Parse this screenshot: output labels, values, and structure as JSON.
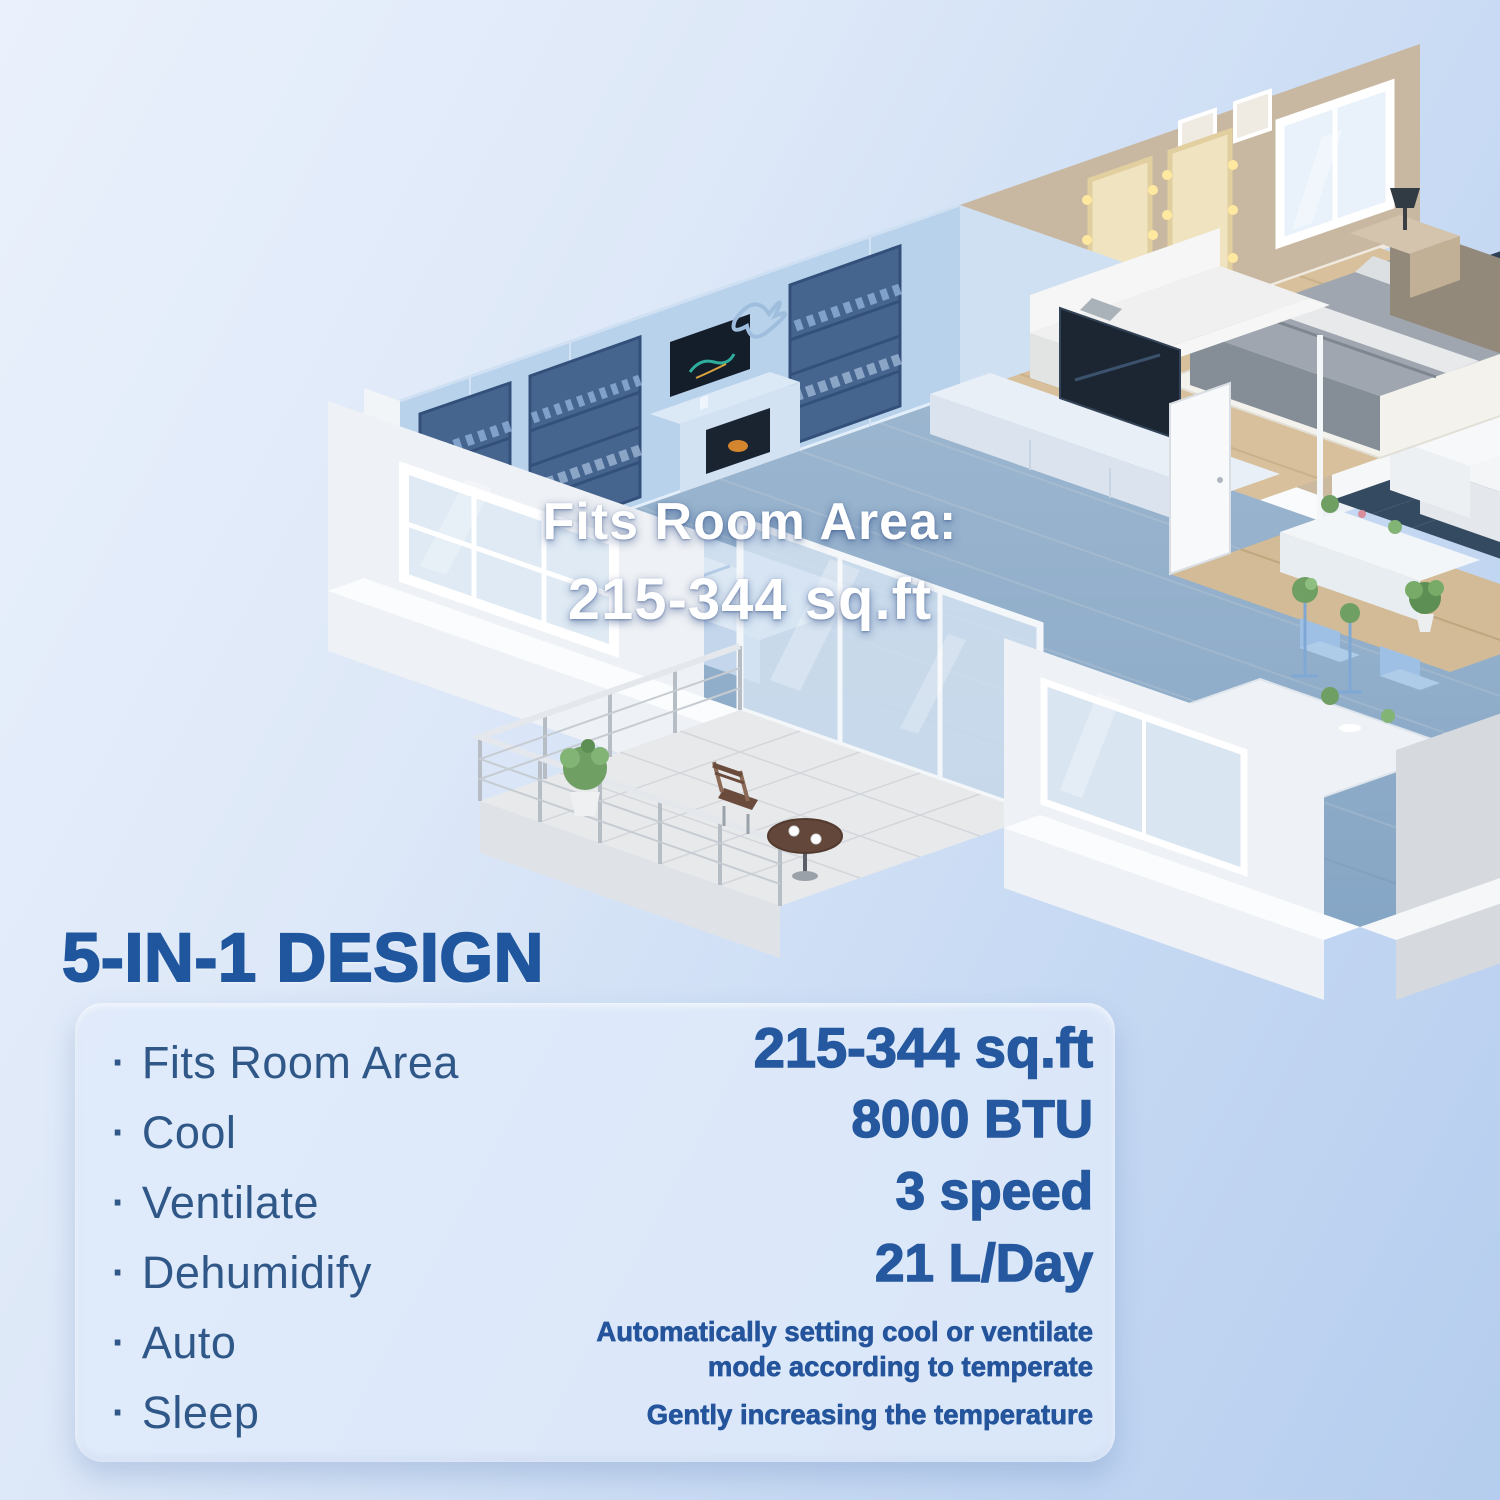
{
  "scene": {
    "name": "3d-apartment-cutaway-floorplan",
    "floor_label": {
      "line1": "Fits Room Area:",
      "line2": "215-344 sq.ft"
    }
  },
  "heading": "5-IN-1 DESIGN",
  "features": {
    "bullet": "·",
    "items": [
      "Fits Room Area",
      "Cool",
      "Ventilate",
      "Dehumidify",
      "Auto",
      "Sleep"
    ]
  },
  "specs": {
    "items": [
      "215-344 sq.ft",
      "8000 BTU",
      "3 speed",
      "21 L/Day"
    ]
  },
  "notes": {
    "auto": "Automatically setting cool or ventilate mode according to temperate",
    "sleep": "Gently increasing the temperature"
  },
  "colors": {
    "heading_text": "#1f569e",
    "feature_text": "#2f5787",
    "spec_text": "#25589e",
    "floor_label_text": "#ffffff",
    "room_highlight": "#5b9be0",
    "panel_background": "#dfeafa",
    "bathroom_tile": "#2e4156",
    "wood_floor": "#d4bd98",
    "bedroom_wall": "#c9b8a1"
  }
}
